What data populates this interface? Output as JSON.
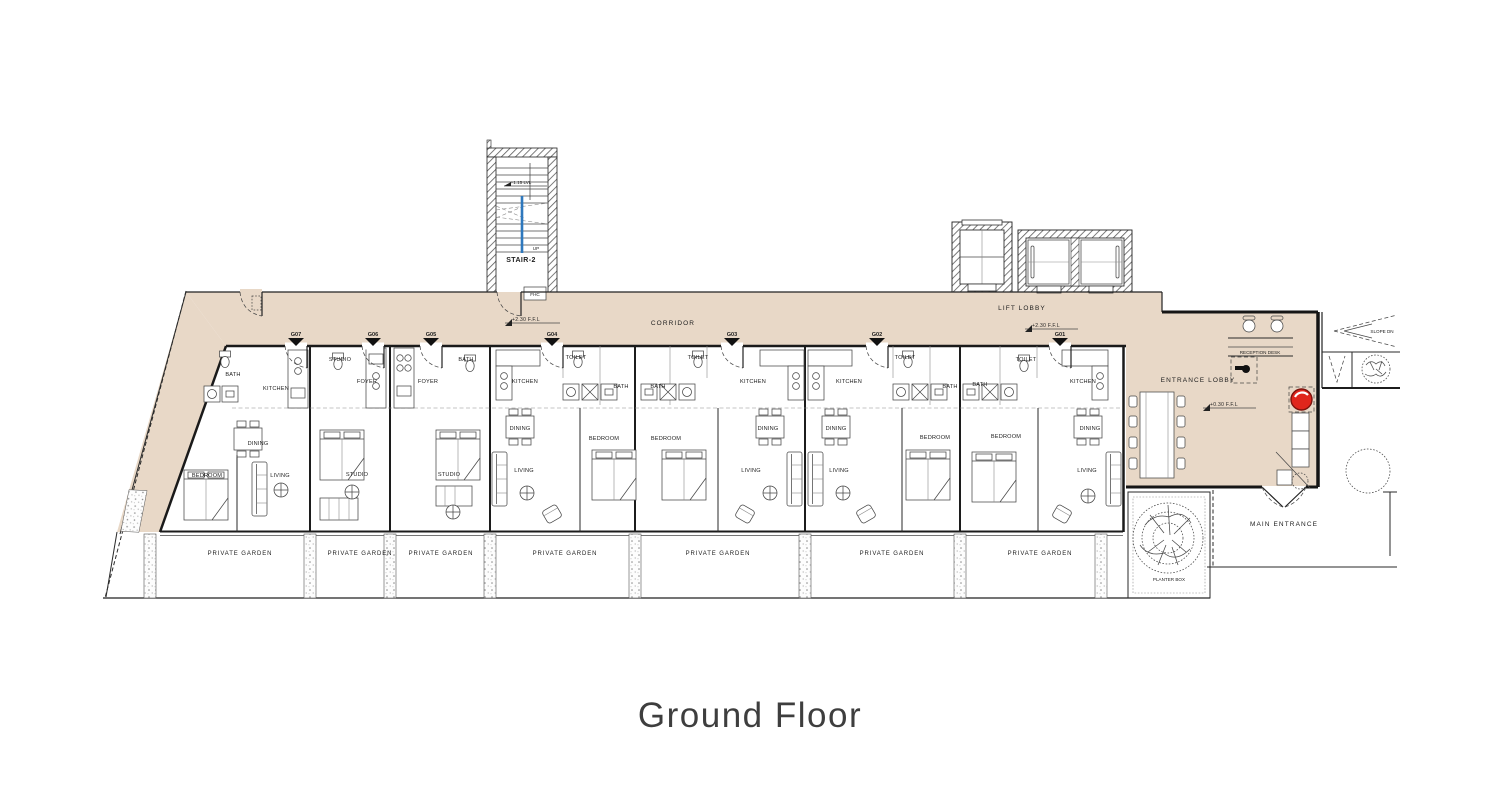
{
  "title": "Ground Floor",
  "colors": {
    "corridor_fill": "#e8d8c7",
    "wall": "#1a1a1a",
    "handrail_blue": "#2e78bd",
    "alarm_red": "#e0261c"
  },
  "stair": {
    "name": "STAIR-2",
    "direction": "UP",
    "level": "+1.15 LVL",
    "fire_hose_cabinet": "FHC"
  },
  "areas": {
    "corridor": {
      "label": "CORRIDOR",
      "level": "+2.30 F.F.L"
    },
    "lift_lobby": {
      "label": "LIFT LOBBY",
      "level": "+2.30 F.F.L"
    },
    "entrance_lobby": {
      "label": "ENTRANCE LOBBY",
      "level": "+0.30 F.F.L",
      "reception_desk": "RECEPTION DESK"
    },
    "main_entrance": {
      "label": "MAIN ENTRANCE"
    },
    "planter_box": {
      "label": "PLANTER BOX"
    },
    "slope": {
      "label": "SLOPE DN"
    }
  },
  "units": [
    {
      "number": "G07",
      "x": 296
    },
    {
      "number": "G06",
      "x": 373
    },
    {
      "number": "G05",
      "x": 431
    },
    {
      "number": "G04",
      "x": 552
    },
    {
      "number": "G03",
      "x": 732
    },
    {
      "number": "G02",
      "x": 877
    },
    {
      "number": "G01",
      "x": 1060
    }
  ],
  "gardens": [
    {
      "label": "PRIVATE GARDEN",
      "x": 240,
      "y": 555
    },
    {
      "label": "PRIVATE GARDEN",
      "x": 360,
      "y": 555
    },
    {
      "label": "PRIVATE GARDEN",
      "x": 441,
      "y": 555
    },
    {
      "label": "PRIVATE GARDEN",
      "x": 565,
      "y": 555
    },
    {
      "label": "PRIVATE GARDEN",
      "x": 718,
      "y": 555
    },
    {
      "label": "PRIVATE GARDEN",
      "x": 892,
      "y": 555
    },
    {
      "label": "PRIVATE GARDEN",
      "x": 1040,
      "y": 555
    }
  ],
  "room_labels": [
    {
      "t": "BATH",
      "x": 233,
      "y": 376
    },
    {
      "t": "KITCHEN",
      "x": 276,
      "y": 390
    },
    {
      "t": "DINING",
      "x": 258,
      "y": 445
    },
    {
      "t": "BEDROOM",
      "x": 207,
      "y": 477
    },
    {
      "t": "LIVING",
      "x": 280,
      "y": 477
    },
    {
      "t": "STUDIO",
      "x": 340,
      "y": 361
    },
    {
      "t": "FOYER",
      "x": 367,
      "y": 383
    },
    {
      "t": "STUDIO",
      "x": 357,
      "y": 476
    },
    {
      "t": "BATH",
      "x": 466,
      "y": 361
    },
    {
      "t": "FOYER",
      "x": 428,
      "y": 383
    },
    {
      "t": "STUDIO",
      "x": 449,
      "y": 476
    },
    {
      "t": "KITCHEN",
      "x": 525,
      "y": 383
    },
    {
      "t": "TOILET",
      "x": 576,
      "y": 359
    },
    {
      "t": "BATH",
      "x": 621,
      "y": 388
    },
    {
      "t": "DINING",
      "x": 520,
      "y": 430
    },
    {
      "t": "BEDROOM",
      "x": 604,
      "y": 440
    },
    {
      "t": "LIVING",
      "x": 524,
      "y": 472
    },
    {
      "t": "BATH",
      "x": 658,
      "y": 388
    },
    {
      "t": "TOILET",
      "x": 698,
      "y": 359
    },
    {
      "t": "BEDROOM",
      "x": 666,
      "y": 440
    },
    {
      "t": "KITCHEN",
      "x": 753,
      "y": 383
    },
    {
      "t": "DINING",
      "x": 768,
      "y": 430
    },
    {
      "t": "LIVING",
      "x": 751,
      "y": 472
    },
    {
      "t": "KITCHEN",
      "x": 849,
      "y": 383
    },
    {
      "t": "TOILET",
      "x": 905,
      "y": 359
    },
    {
      "t": "BATH",
      "x": 950,
      "y": 388
    },
    {
      "t": "DINING",
      "x": 836,
      "y": 430
    },
    {
      "t": "BEDROOM",
      "x": 935,
      "y": 439
    },
    {
      "t": "LIVING",
      "x": 839,
      "y": 472
    },
    {
      "t": "BATH",
      "x": 980,
      "y": 386
    },
    {
      "t": "TOILET",
      "x": 1026,
      "y": 361
    },
    {
      "t": "KITCHEN",
      "x": 1083,
      "y": 383
    },
    {
      "t": "BEDROOM",
      "x": 1006,
      "y": 438
    },
    {
      "t": "DINING",
      "x": 1090,
      "y": 430
    },
    {
      "t": "LIVING",
      "x": 1087,
      "y": 472
    }
  ]
}
